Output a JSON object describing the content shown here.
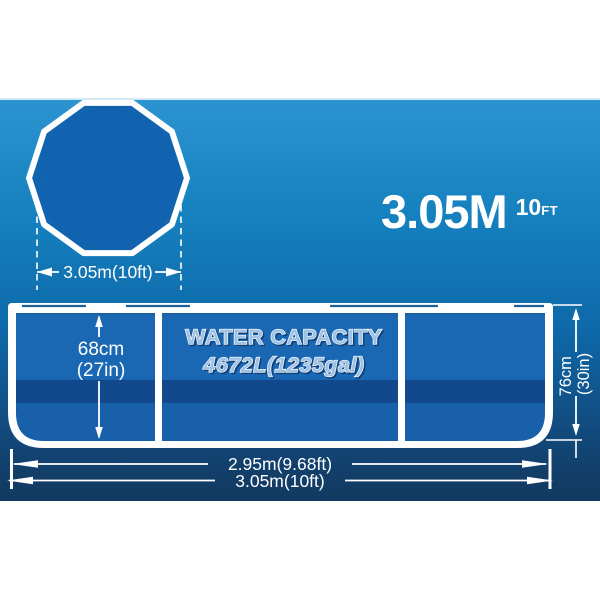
{
  "palette": {
    "background_top": "#2B94D0",
    "background_bottom": "#113A61",
    "panel_blue": "#1A68B4",
    "stripe_blue": "#11498C",
    "panel_lower_blue": "#1860A9",
    "pool_top_fill": "#1263AF",
    "outline_white": "#FFFFFF",
    "capacity_fill": "#9DC2E6"
  },
  "top_view": {
    "diameter_label": "3.05m(10ft)"
  },
  "headline": {
    "metric": "3.05M",
    "imperial_value": "10",
    "imperial_unit": "FT"
  },
  "side_view": {
    "capacity_title": "WATER CAPACITY",
    "capacity_value": "4672L(1235gal)",
    "inner_height_metric": "68cm",
    "inner_height_imperial": "(27in)",
    "outer_height_metric": "76cm",
    "outer_height_imperial": "(30in)",
    "inner_width_label": "2.95m(9.68ft)",
    "outer_width_label": "3.05m(10ft)"
  }
}
